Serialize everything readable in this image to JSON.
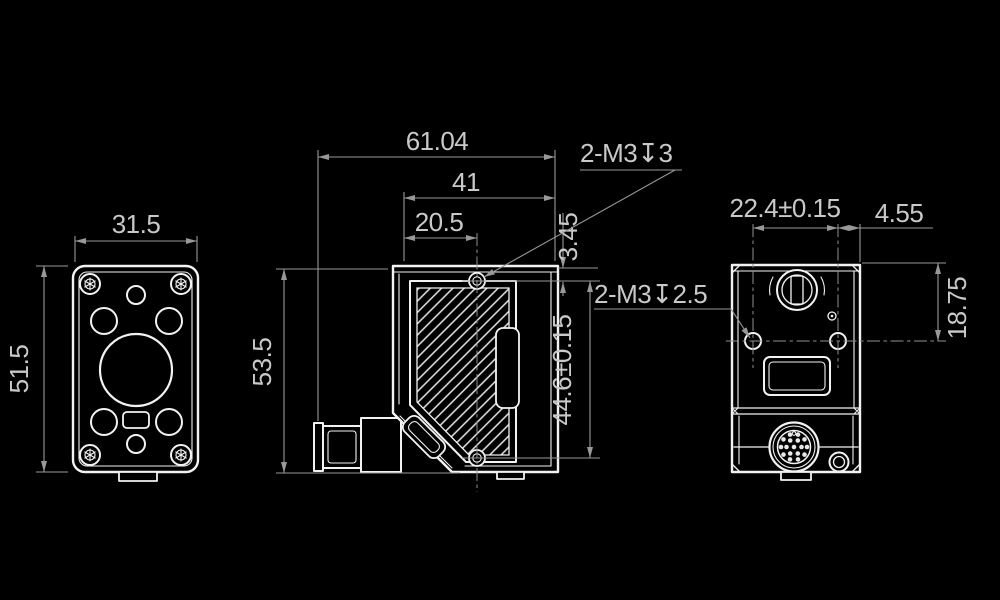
{
  "colors": {
    "background": "#000000",
    "outline": "#f2f2f2",
    "dimension_lines": "#989898",
    "text": "#c9c9c9"
  },
  "dims": {
    "front_width": "31.5",
    "front_height": "51.5",
    "side_height": "53.5",
    "side_total_width": "61.04",
    "side_upper_width": "41",
    "side_hole_offset": "20.5",
    "side_hole_top_gap": "3.45",
    "side_hole_spacing": "44.6±0.15",
    "thread_top": "2-M3↧3",
    "thread_rear": "2-M3↧2.5",
    "rear_hole_spacing": "22.4±0.15",
    "rear_hole_edge_gap": "4.55",
    "rear_top_to_center": "18.75"
  }
}
